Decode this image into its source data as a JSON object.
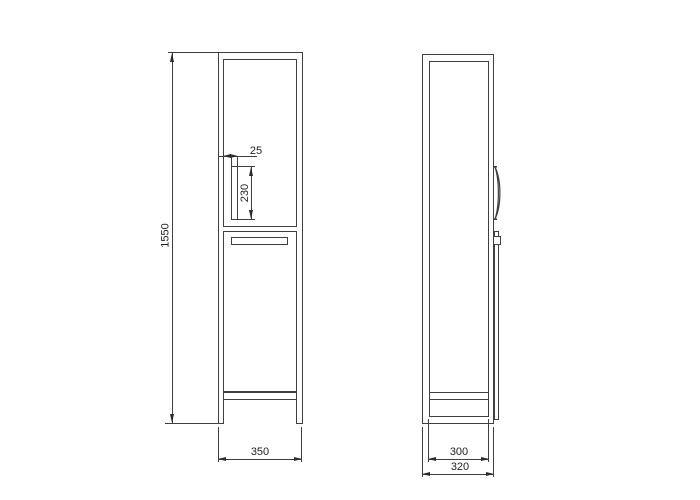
{
  "drawing": {
    "type": "technical-orthographic-cabinet-drawing",
    "background": "#ffffff",
    "line_color": "#3f3f3f",
    "text_color": "#1f1f1f",
    "front_view": {
      "dimensions": {
        "overall_height": "1550",
        "handle_width": "25",
        "handle_length": "230",
        "overall_width": "350"
      }
    },
    "side_view": {
      "dimensions": {
        "body_depth": "300",
        "overall_depth": "320"
      }
    }
  }
}
